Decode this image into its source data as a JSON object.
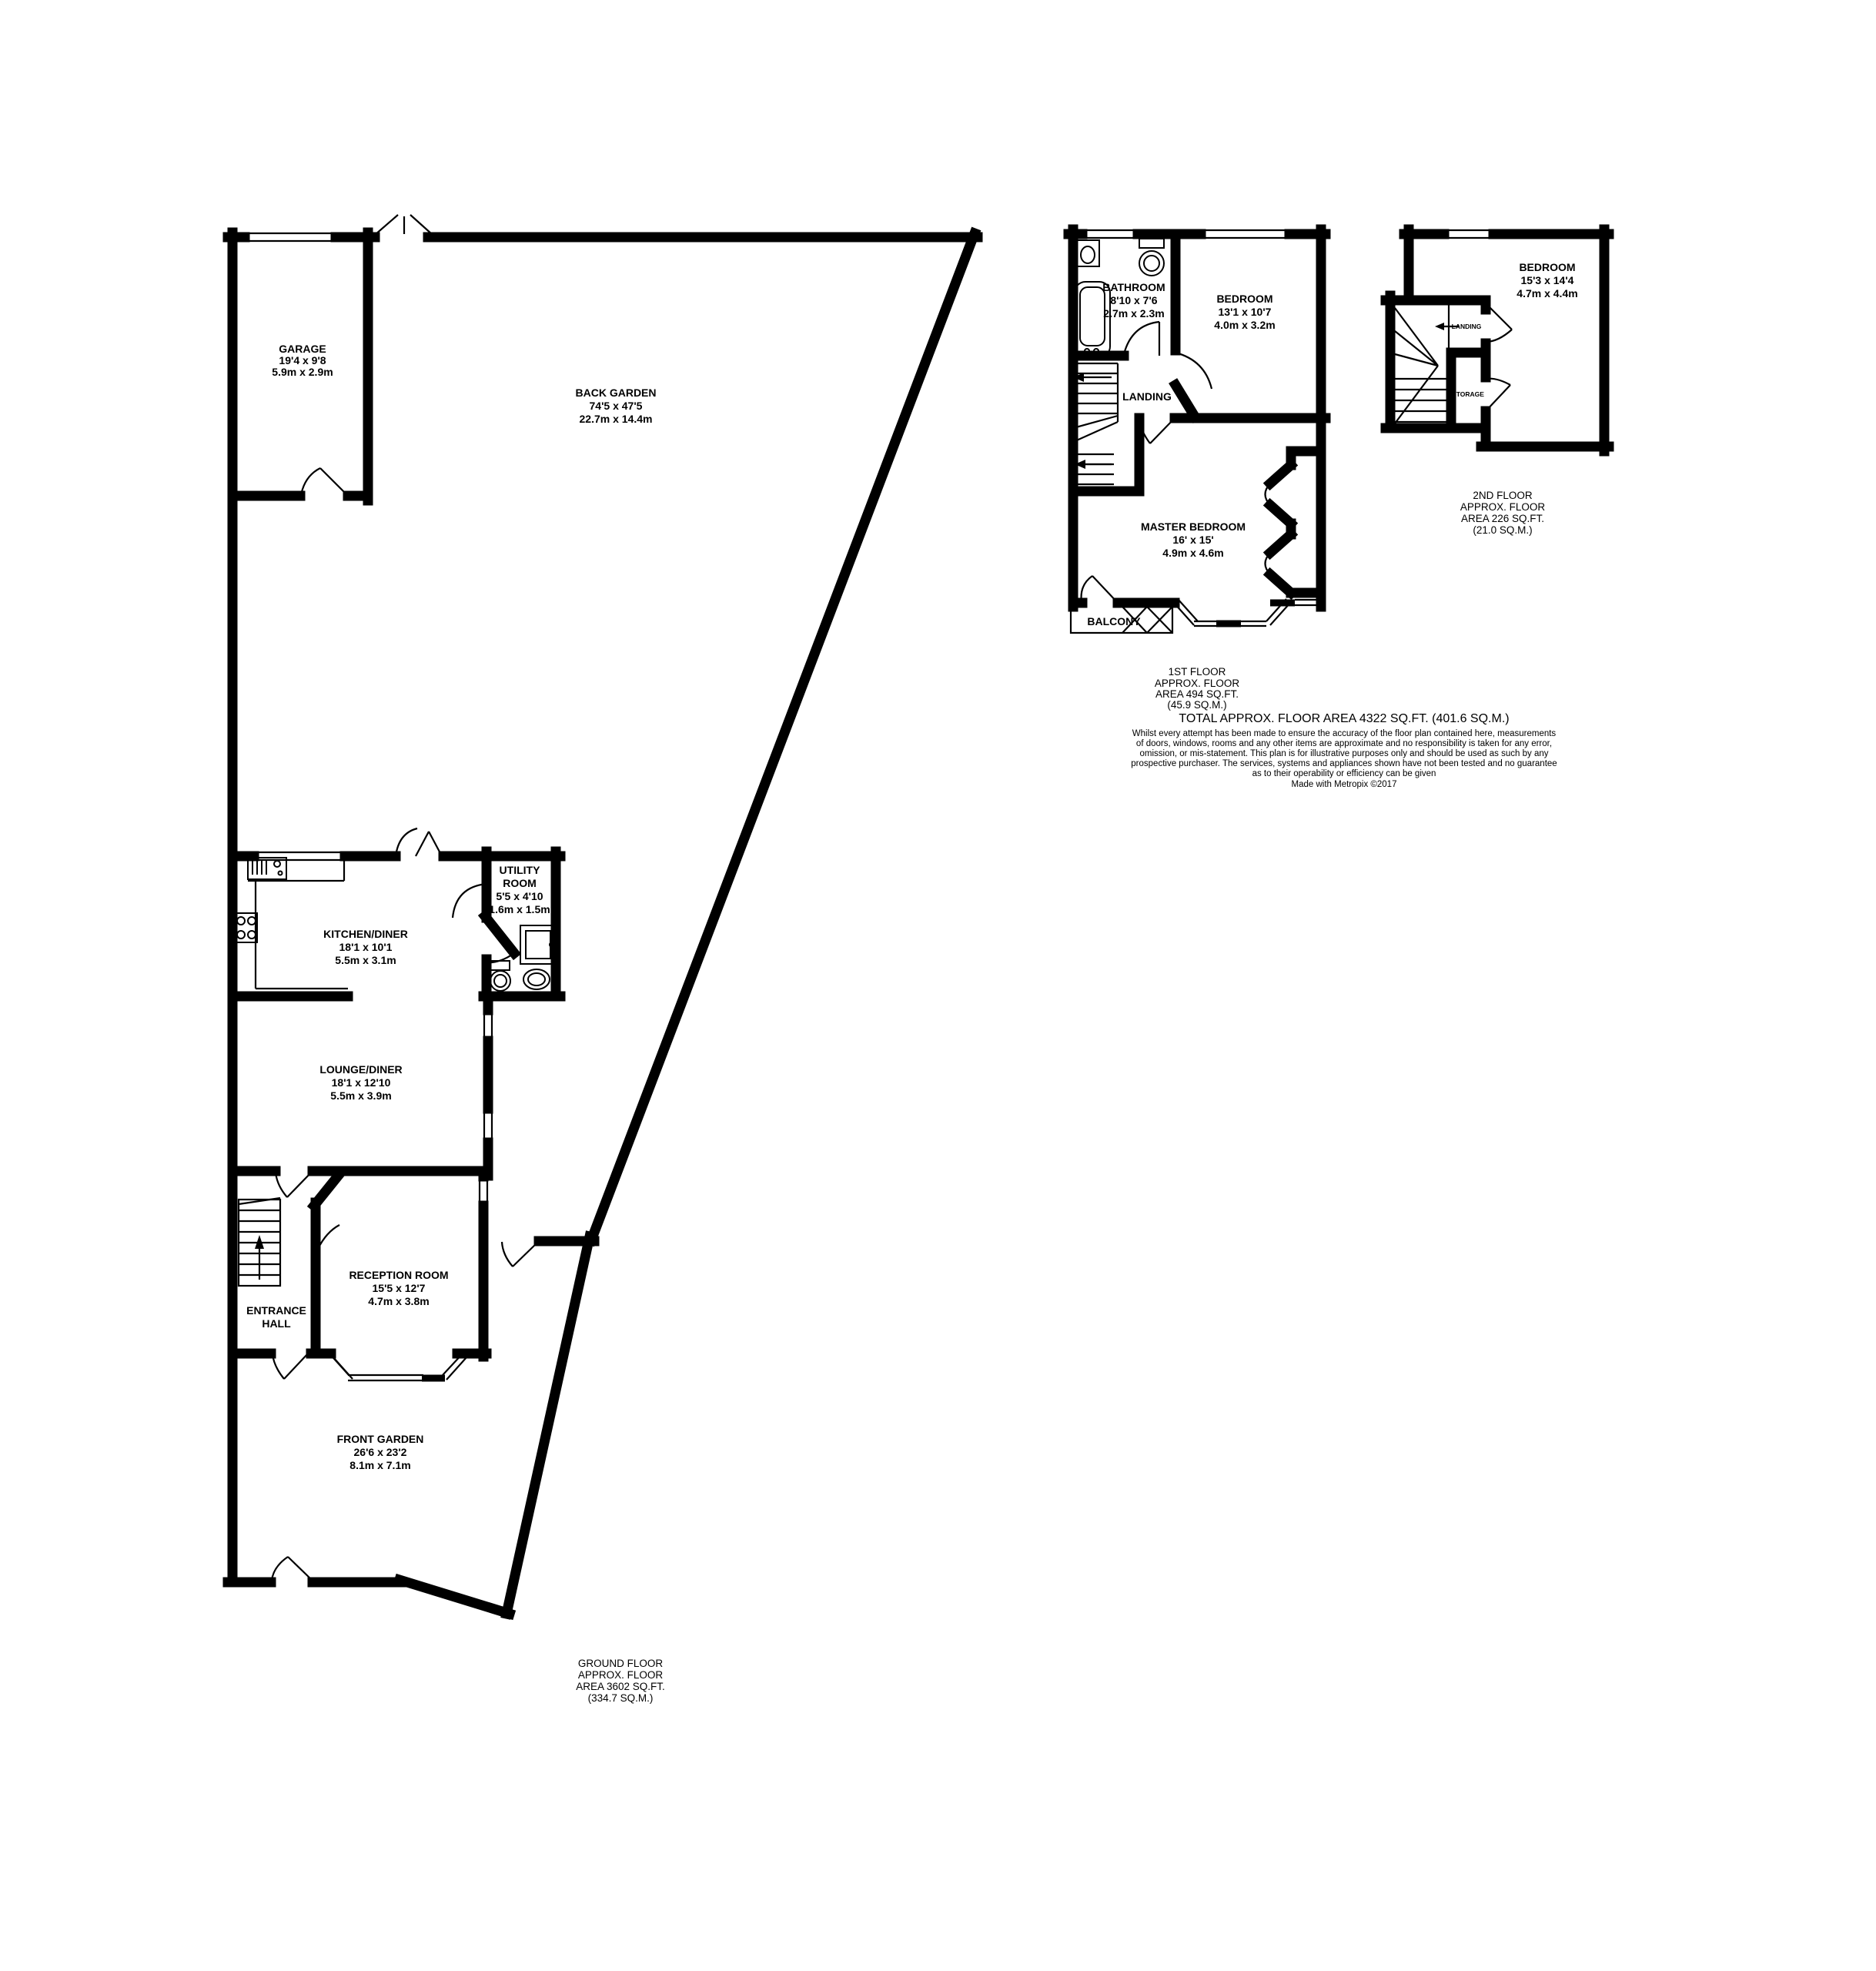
{
  "document": {
    "total_area_line": "TOTAL APPROX. FLOOR AREA 4322 SQ.FT. (401.6 SQ.M.)",
    "disclaimer_lines": [
      "Whilst every attempt has been made to ensure the accuracy of the floor plan contained here, measurements",
      "of doors, windows, rooms and any other items are approximate and no responsibility is taken for any error,",
      "omission, or mis-statement. This plan is for illustrative purposes only and should be used as such by any",
      "prospective purchaser. The services, systems and appliances shown have not been tested and no guarantee",
      "as to their operability or efficiency can be given"
    ],
    "made_with": "Made with Metropix ©2017"
  },
  "ground_floor": {
    "area_label": {
      "lines": [
        "GROUND FLOOR",
        "APPROX. FLOOR",
        "AREA 3602 SQ.FT.",
        "(334.7 SQ.M.)"
      ]
    },
    "rooms": {
      "garage": {
        "name": "GARAGE",
        "imperial": "19'4 x 9'8",
        "metric": "5.9m x 2.9m"
      },
      "back_garden": {
        "name": "BACK GARDEN",
        "imperial": "74'5 x 47'5",
        "metric": "22.7m x 14.4m"
      },
      "kitchen_diner": {
        "name": "KITCHEN/DINER",
        "imperial": "18'1 x 10'1",
        "metric": "5.5m x 3.1m"
      },
      "utility_room": {
        "name_line1": "UTILITY",
        "name_line2": "ROOM",
        "imperial": "5'5 x 4'10",
        "metric": "1.6m x 1.5m"
      },
      "lounge_diner": {
        "name": "LOUNGE/DINER",
        "imperial": "18'1 x 12'10",
        "metric": "5.5m x 3.9m"
      },
      "reception_room": {
        "name": "RECEPTION ROOM",
        "imperial": "15'5 x 12'7",
        "metric": "4.7m x 3.8m"
      },
      "entrance_hall": {
        "name_line1": "ENTRANCE",
        "name_line2": "HALL"
      },
      "front_garden": {
        "name": "FRONT GARDEN",
        "imperial": "26'6 x 23'2",
        "metric": "8.1m x 7.1m"
      }
    }
  },
  "first_floor": {
    "area_label": {
      "lines": [
        "1ST FLOOR",
        "APPROX. FLOOR",
        "AREA 494 SQ.FT.",
        "(45.9 SQ.M.)"
      ]
    },
    "rooms": {
      "bathroom": {
        "name": "BATHROOM",
        "imperial": "8'10 x 7'6",
        "metric": "2.7m x 2.3m"
      },
      "bedroom": {
        "name": "BEDROOM",
        "imperial": "13'1 x 10'7",
        "metric": "4.0m x 3.2m"
      },
      "landing": {
        "name": "LANDING"
      },
      "master_bedroom": {
        "name": "MASTER BEDROOM",
        "imperial": "16' x 15'",
        "metric": "4.9m x 4.6m"
      },
      "balcony": {
        "name": "BALCONY"
      }
    }
  },
  "second_floor": {
    "area_label": {
      "lines": [
        "2ND FLOOR",
        "APPROX. FLOOR",
        "AREA 226 SQ.FT.",
        "(21.0 SQ.M.)"
      ]
    },
    "rooms": {
      "bedroom": {
        "name": "BEDROOM",
        "imperial": "15'3 x 14'4",
        "metric": "4.7m x 4.4m"
      },
      "landing": {
        "name": "LANDING"
      },
      "storage": {
        "name": "STORAGE"
      }
    }
  },
  "colors": {
    "wall": "#000000",
    "background": "#ffffff"
  }
}
